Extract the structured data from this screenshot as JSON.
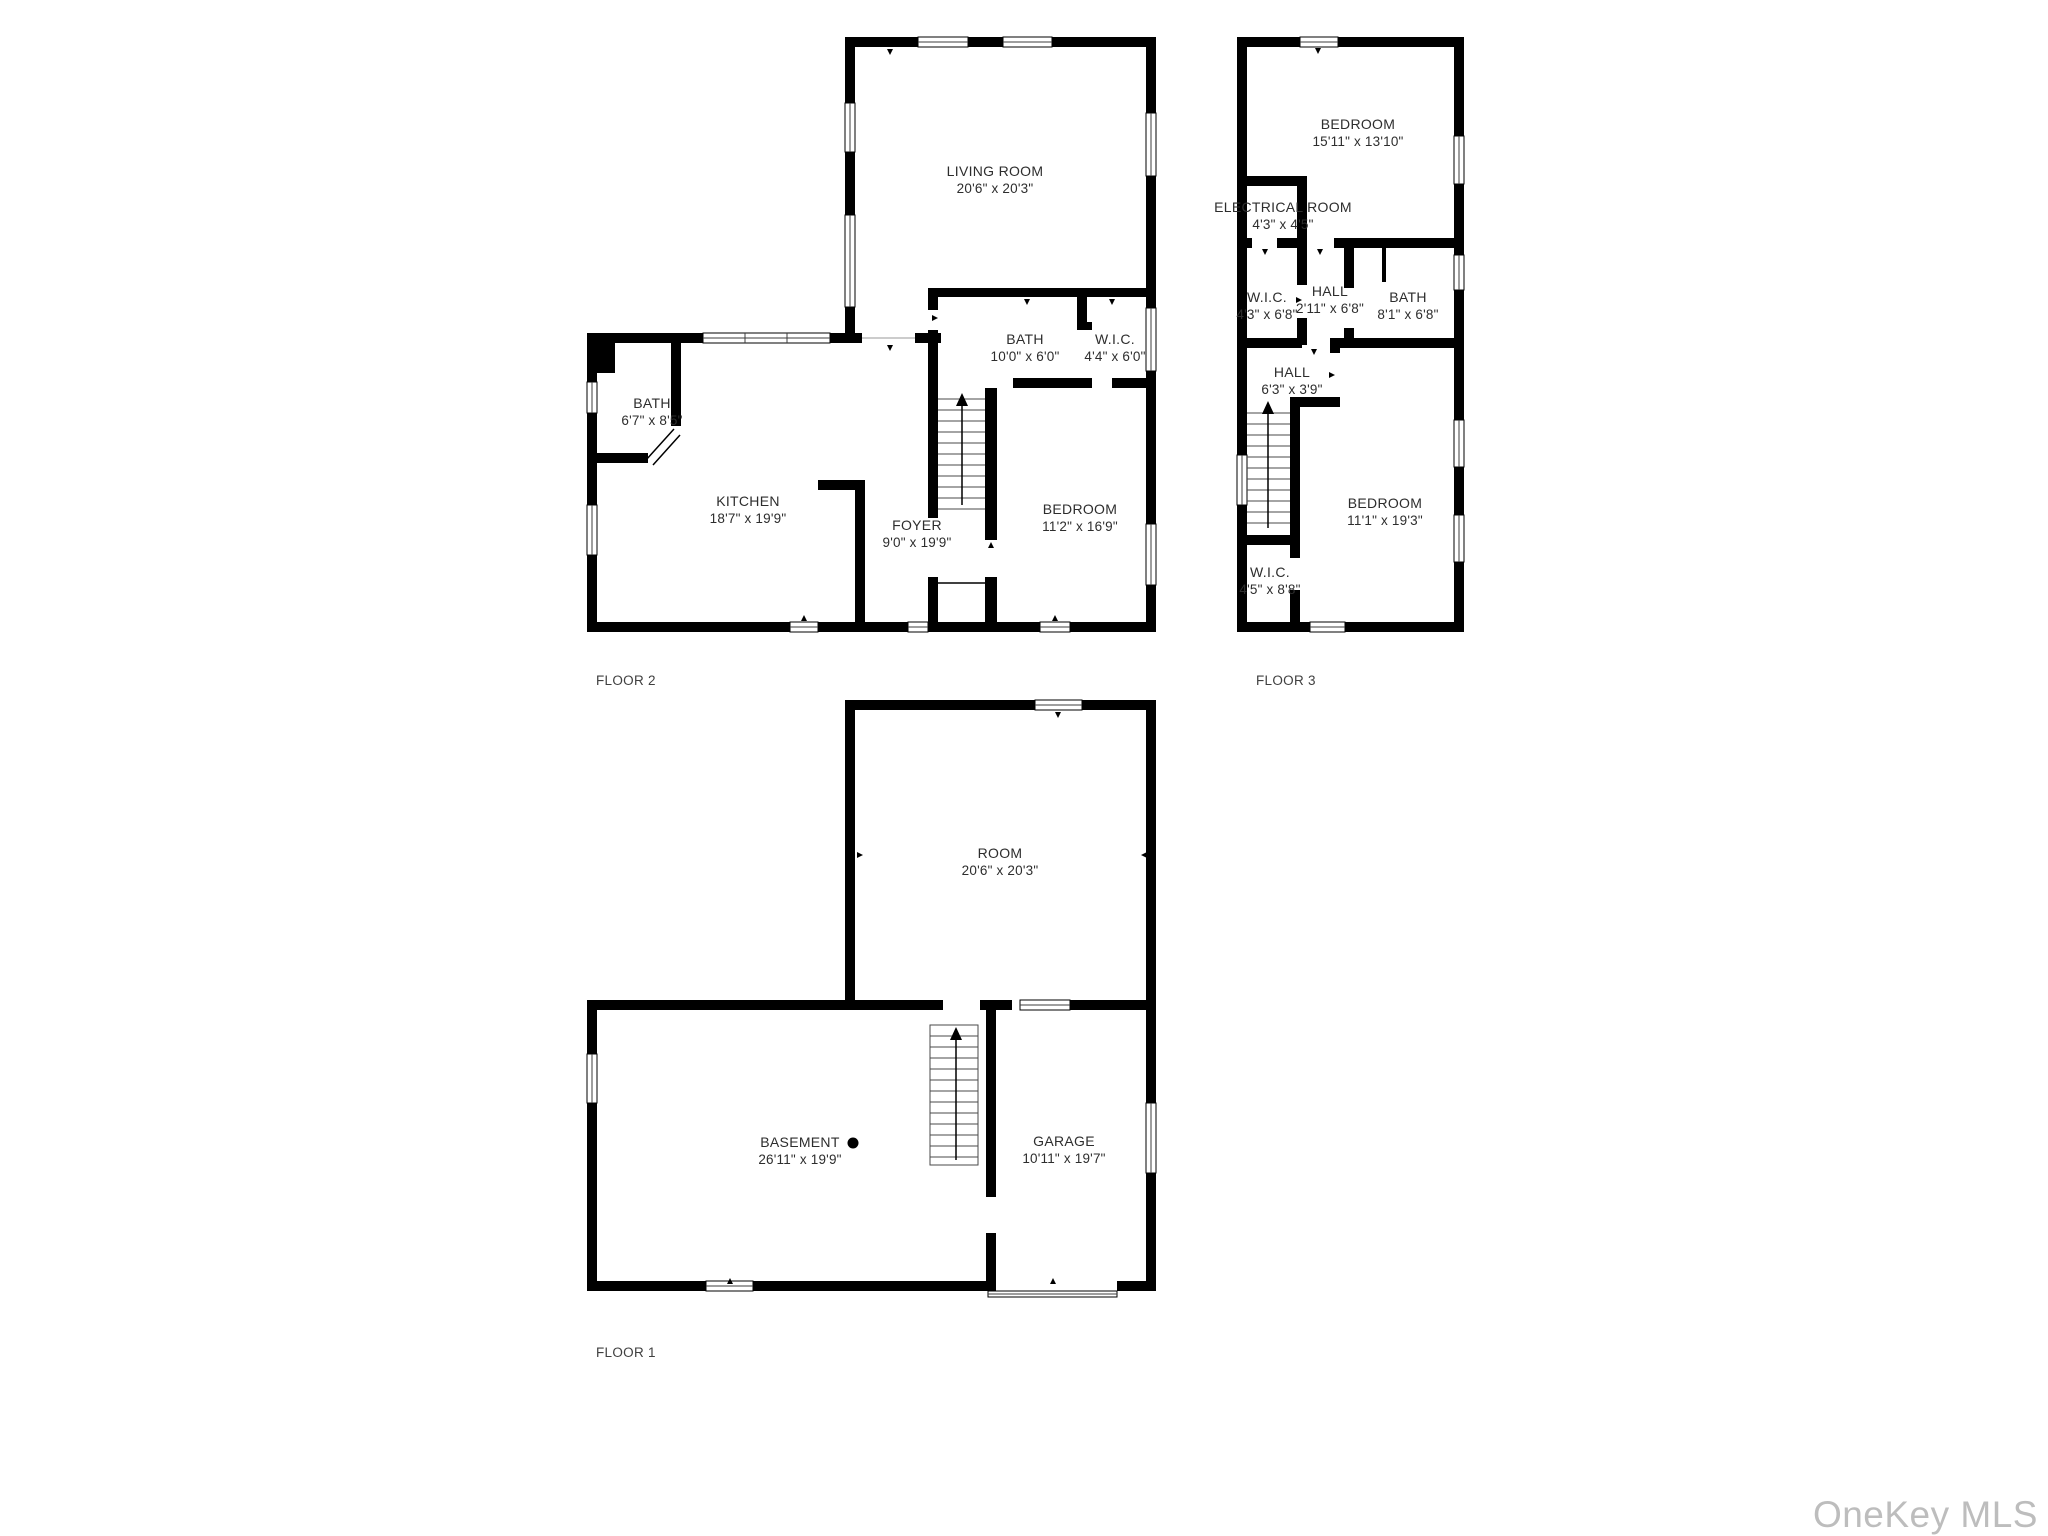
{
  "watermark": "OneKey MLS",
  "colors": {
    "wall": "#000000",
    "label_text": "#2d2d2d",
    "watermark_gray": "#bdbdbd"
  },
  "floors": [
    {
      "label": "FLOOR 2",
      "rooms": [
        {
          "name": "LIVING ROOM",
          "dims": "20'6\" x 20'3\""
        },
        {
          "name": "BATH",
          "dims": "6'7\" x 8'5\""
        },
        {
          "name": "KITCHEN",
          "dims": "18'7\" x 19'9\""
        },
        {
          "name": "FOYER",
          "dims": "9'0\" x 19'9\""
        },
        {
          "name": "BATH",
          "dims": "10'0\" x 6'0\""
        },
        {
          "name": "W.I.C.",
          "dims": "4'4\" x 6'0\""
        },
        {
          "name": "BEDROOM",
          "dims": "11'2\" x 16'9\""
        }
      ]
    },
    {
      "label": "FLOOR 3",
      "rooms": [
        {
          "name": "BEDROOM",
          "dims": "15'11\" x 13'10\""
        },
        {
          "name": "ELECTRICAL ROOM",
          "dims": "4'3\" x 4'5\""
        },
        {
          "name": "W.I.C.",
          "dims": "4'3\" x 6'8\""
        },
        {
          "name": "HALL",
          "dims": "2'11\" x 6'8\""
        },
        {
          "name": "BATH",
          "dims": "8'1\" x 6'8\""
        },
        {
          "name": "HALL",
          "dims": "6'3\" x 3'9\""
        },
        {
          "name": "BEDROOM",
          "dims": "11'1\" x 19'3\""
        },
        {
          "name": "W.I.C.",
          "dims": "4'5\" x 8'8\""
        }
      ]
    },
    {
      "label": "FLOOR 1",
      "rooms": [
        {
          "name": "ROOM",
          "dims": "20'6\" x 20'3\""
        },
        {
          "name": "BASEMENT",
          "dims": "26'11\" x 19'9\""
        },
        {
          "name": "GARAGE",
          "dims": "10'11\" x 19'7\""
        }
      ]
    }
  ]
}
